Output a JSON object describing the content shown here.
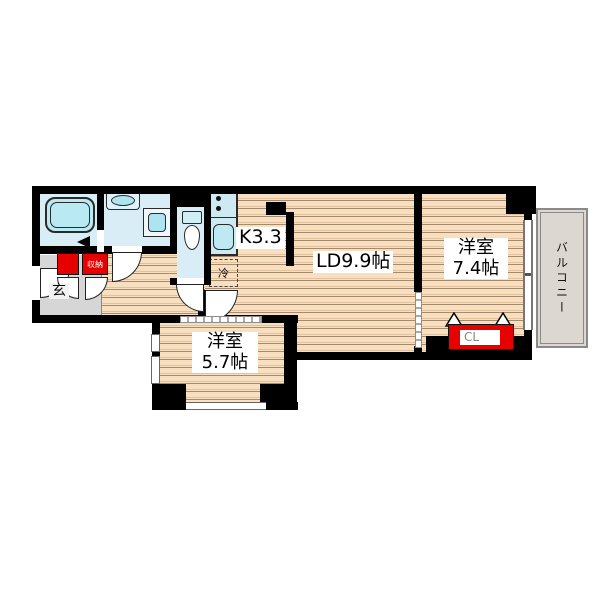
{
  "plan": {
    "labels": {
      "kitchen": "K3.3",
      "living_dining": "LD9.9帖",
      "bedroom_right_name": "洋室",
      "bedroom_right_size": "7.4帖",
      "bedroom_bottom_name": "洋室",
      "bedroom_bottom_size": "5.7帖",
      "balcony": "バルコニー",
      "entrance": "玄",
      "closet": "CL",
      "storage": "収納",
      "refrigerator": "冷"
    },
    "colors": {
      "wall": "#000000",
      "flooring": "#f8dfc0",
      "flooring_stripe": "#a58a6f",
      "wet_area_floor": "#d9edf7",
      "fixture_fill": "#b9e9f2",
      "accent_red": "#e60000",
      "entrance_floor": "#d6d6d6",
      "balcony_floor": "#dcd7d0",
      "balcony_border": "#8a8a8a"
    }
  }
}
